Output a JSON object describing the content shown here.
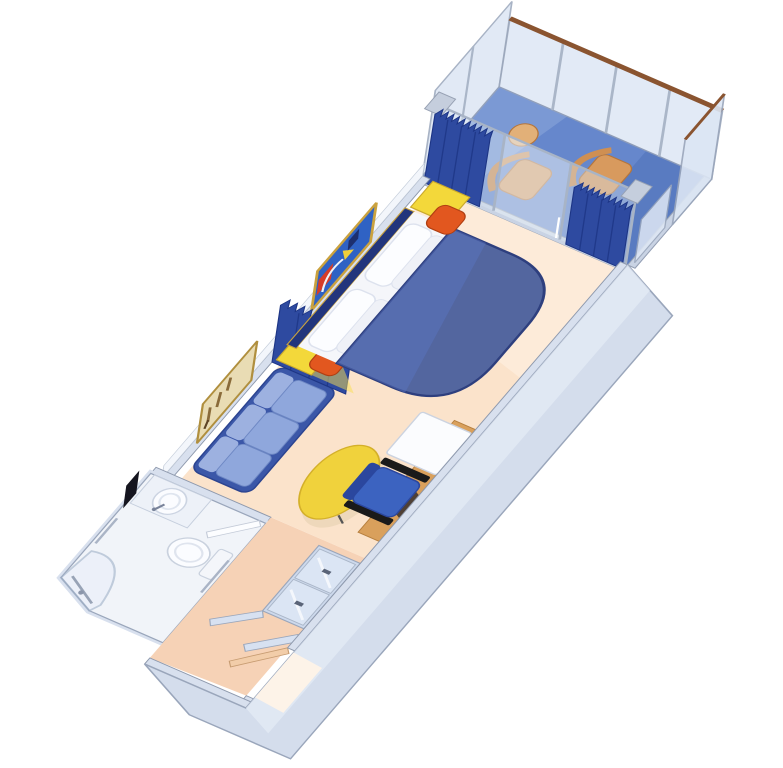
{
  "scene": {
    "name": "balcony-stateroom-floorplan",
    "description": "Isometric cutaway floor plan illustration of a cruise ship balcony stateroom",
    "background": "#ffffff"
  },
  "colors": {
    "wall": "#d8e0ee",
    "wall_edge": "#8e99ad",
    "wall_band": "#d4ddec",
    "wall_face": "#f3f6fb",
    "glass": "#dce6f4",
    "glass_frame": "#a0acc0",
    "floor_cabin": "#fbe3cb",
    "floor_corridor": "#f6d2b6",
    "floor_bathroom": "#f1f4f9",
    "balcony_deck": "#6687cc",
    "bed_blue": "#53669f",
    "bed_edge": "#2e3f7e",
    "headboard": "#22357c",
    "pillow": "#fcfdff",
    "sofa_base": "#3b57a8",
    "sofa_cushion": "#8fa7dc",
    "cushion_orange": "#e2571f",
    "furniture_yellow": "#f3d83a",
    "table_yellow": "#f0d23c",
    "balcony_tan": "#d89a5e",
    "desk_wood": "#d9a05c",
    "curtain_blue": "#2e4aa0",
    "curtain_dark": "#1d3585",
    "rail_wood": "#8a5430",
    "chair_blue": "#3c63c0",
    "art_cream": "#e9dcb4",
    "art_blue": "#2f62c4",
    "art_red": "#d63c28",
    "art_gold": "#b08f3e",
    "fixture_white": "#fbfcff",
    "mirror": "#dbe5f4",
    "black": "#15151f"
  },
  "rooms": [
    {
      "id": "cabin",
      "name": "stateroom cabin"
    },
    {
      "id": "balcony",
      "name": "private balcony"
    },
    {
      "id": "bathroom",
      "name": "bathroom"
    },
    {
      "id": "entrance-hall",
      "name": "entrance hallway"
    }
  ],
  "furniture": [
    "double-bed",
    "pillows",
    "headboard",
    "nightstand-left",
    "nightstand-right",
    "cushion-left",
    "cushion-right",
    "sofa",
    "coffee-table",
    "desk",
    "desk-chair",
    "tv-cabinet",
    "room-divider-curtain",
    "window-curtain-left",
    "window-curtain-right",
    "sliding-glass-door",
    "balcony-chair-1",
    "balcony-chair-2",
    "balcony-table",
    "balcony-railing",
    "privacy-divider-left",
    "privacy-divider-right",
    "toilet",
    "sink",
    "shower",
    "bathroom-door",
    "closet",
    "entry-door",
    "artwork-above-bed",
    "artwork-above-sofa"
  ]
}
